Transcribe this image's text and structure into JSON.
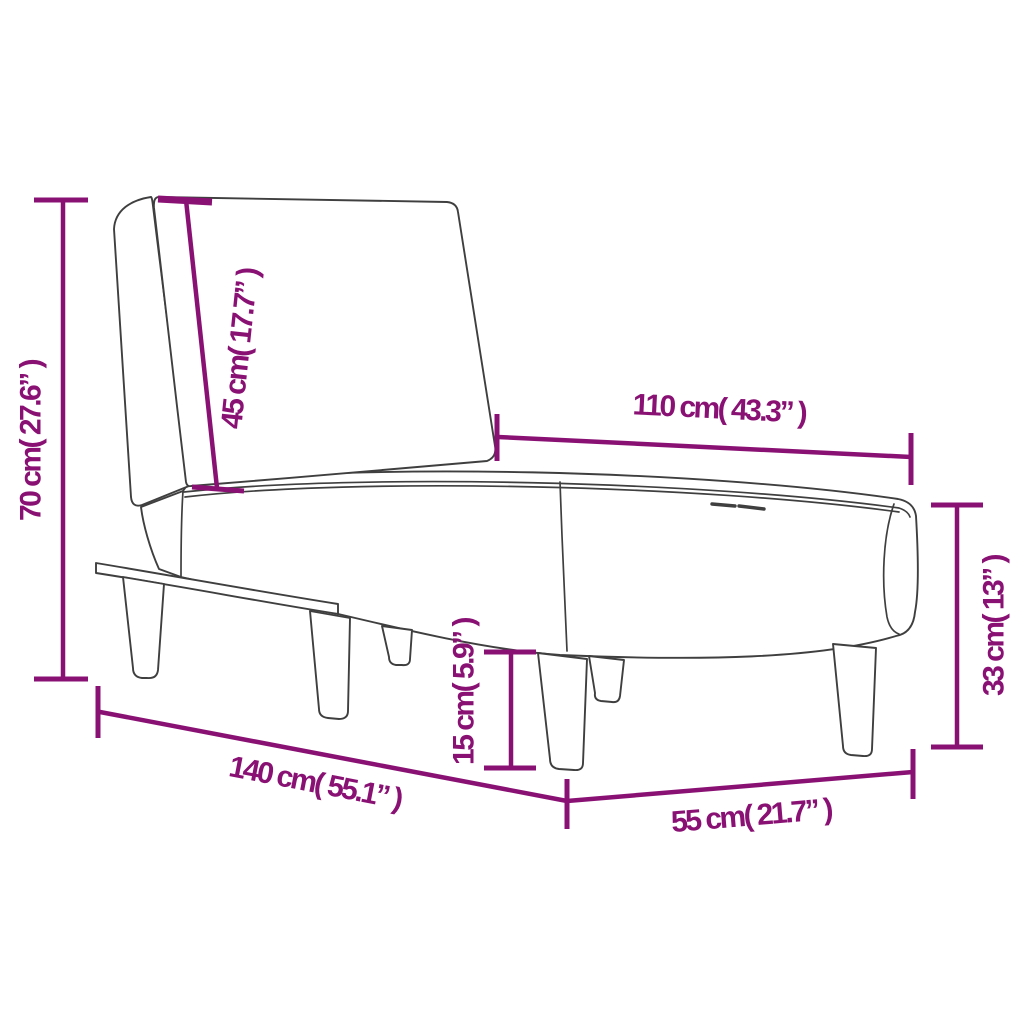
{
  "diagram": {
    "title": "Chaise longue dimension diagram",
    "colors": {
      "accent": "#8A1174",
      "outline": "#3F3F3F",
      "background": "#FFFFFF"
    },
    "dimensions": {
      "overall_height": "70 cm( 27.6” )",
      "backrest_length": "45 cm( 17.7” )",
      "seat_length": "110 cm( 43.3” )",
      "seat_height": "33 cm( 13” )",
      "leg_height": "15 cm( 5.9” )",
      "overall_length": "140 cm( 55.1” )",
      "overall_width": "55 cm( 21.7” )"
    }
  }
}
